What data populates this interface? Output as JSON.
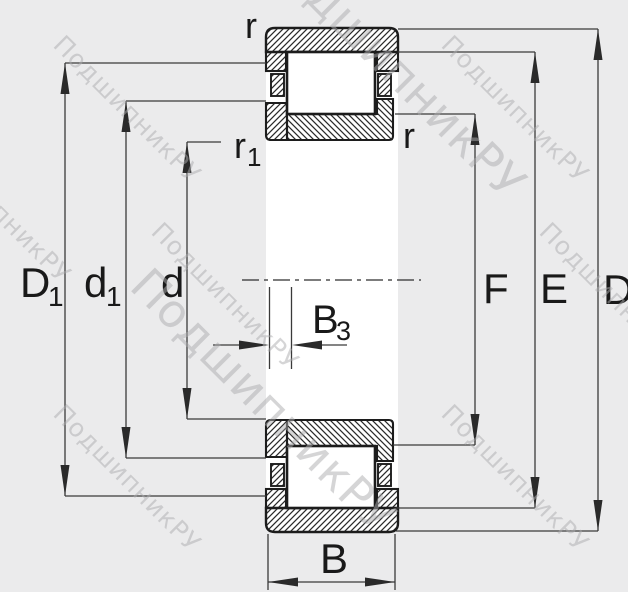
{
  "drawing": {
    "type_note": "cylindrical-roller-bearing-cross-section",
    "watermark": {
      "text": "ПодшипникРУ"
    },
    "dimensions": {
      "D1": {
        "main": "D",
        "sub": "1"
      },
      "d1": {
        "main": "d",
        "sub": "1"
      },
      "d": {
        "main": "d"
      },
      "F": {
        "main": "F"
      },
      "E": {
        "main": "E"
      },
      "D": {
        "main": "D"
      },
      "B": {
        "main": "B"
      },
      "B3": {
        "main": "B",
        "sub": "3"
      },
      "r_top": {
        "main": "r"
      },
      "r_side": {
        "main": "r"
      },
      "r1": {
        "main": "r",
        "sub": "1"
      }
    },
    "colors": {
      "background": "#ebebec",
      "paper": "#ffffff",
      "outline": "#1c1c1c",
      "dim_line": "#3a3a3a",
      "watermark": "#adadaf",
      "subscript_blue": "#3a6fb0",
      "subscript_navy": "#2c4a6e"
    }
  }
}
